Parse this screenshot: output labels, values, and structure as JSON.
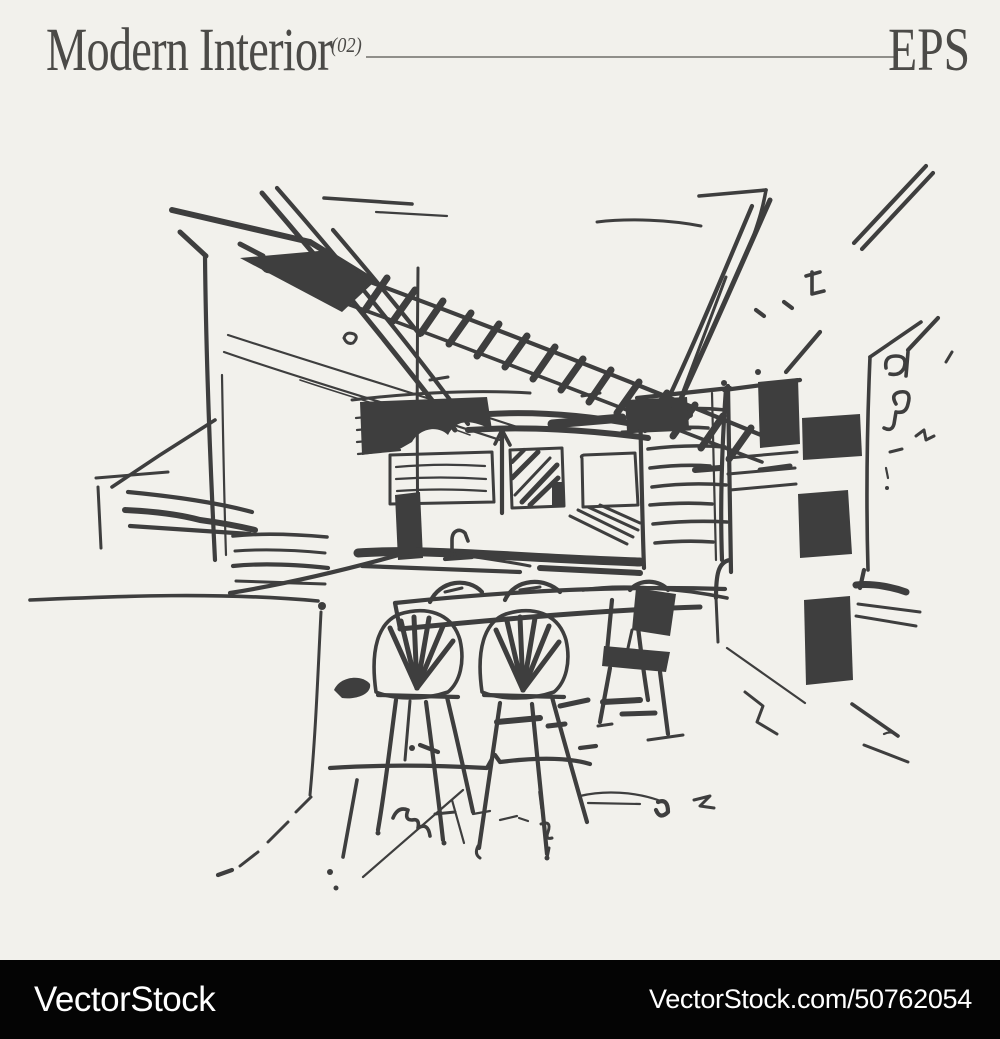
{
  "theme": {
    "--bg": "#f2f1ec",
    "--ink": "#3e3e3e",
    "--header-text": "#4b4a47",
    "--rule": "#908f8a",
    "--footer-bg": "#040404",
    "--footer-text": "#ffffff"
  },
  "header": {
    "title": "Modern Interior",
    "index": "(02)",
    "format": "EPS"
  },
  "illustration": {
    "alt": "Hand-drawn charcoal sketch of a modern interior: dining table with fan-back chairs, kitchen cabinets, tray ceiling and shelving",
    "stroke_color": "#3e3e3e"
  },
  "footer": {
    "brand": "VectorStock",
    "attribution": "VectorStock.com/50762054"
  }
}
